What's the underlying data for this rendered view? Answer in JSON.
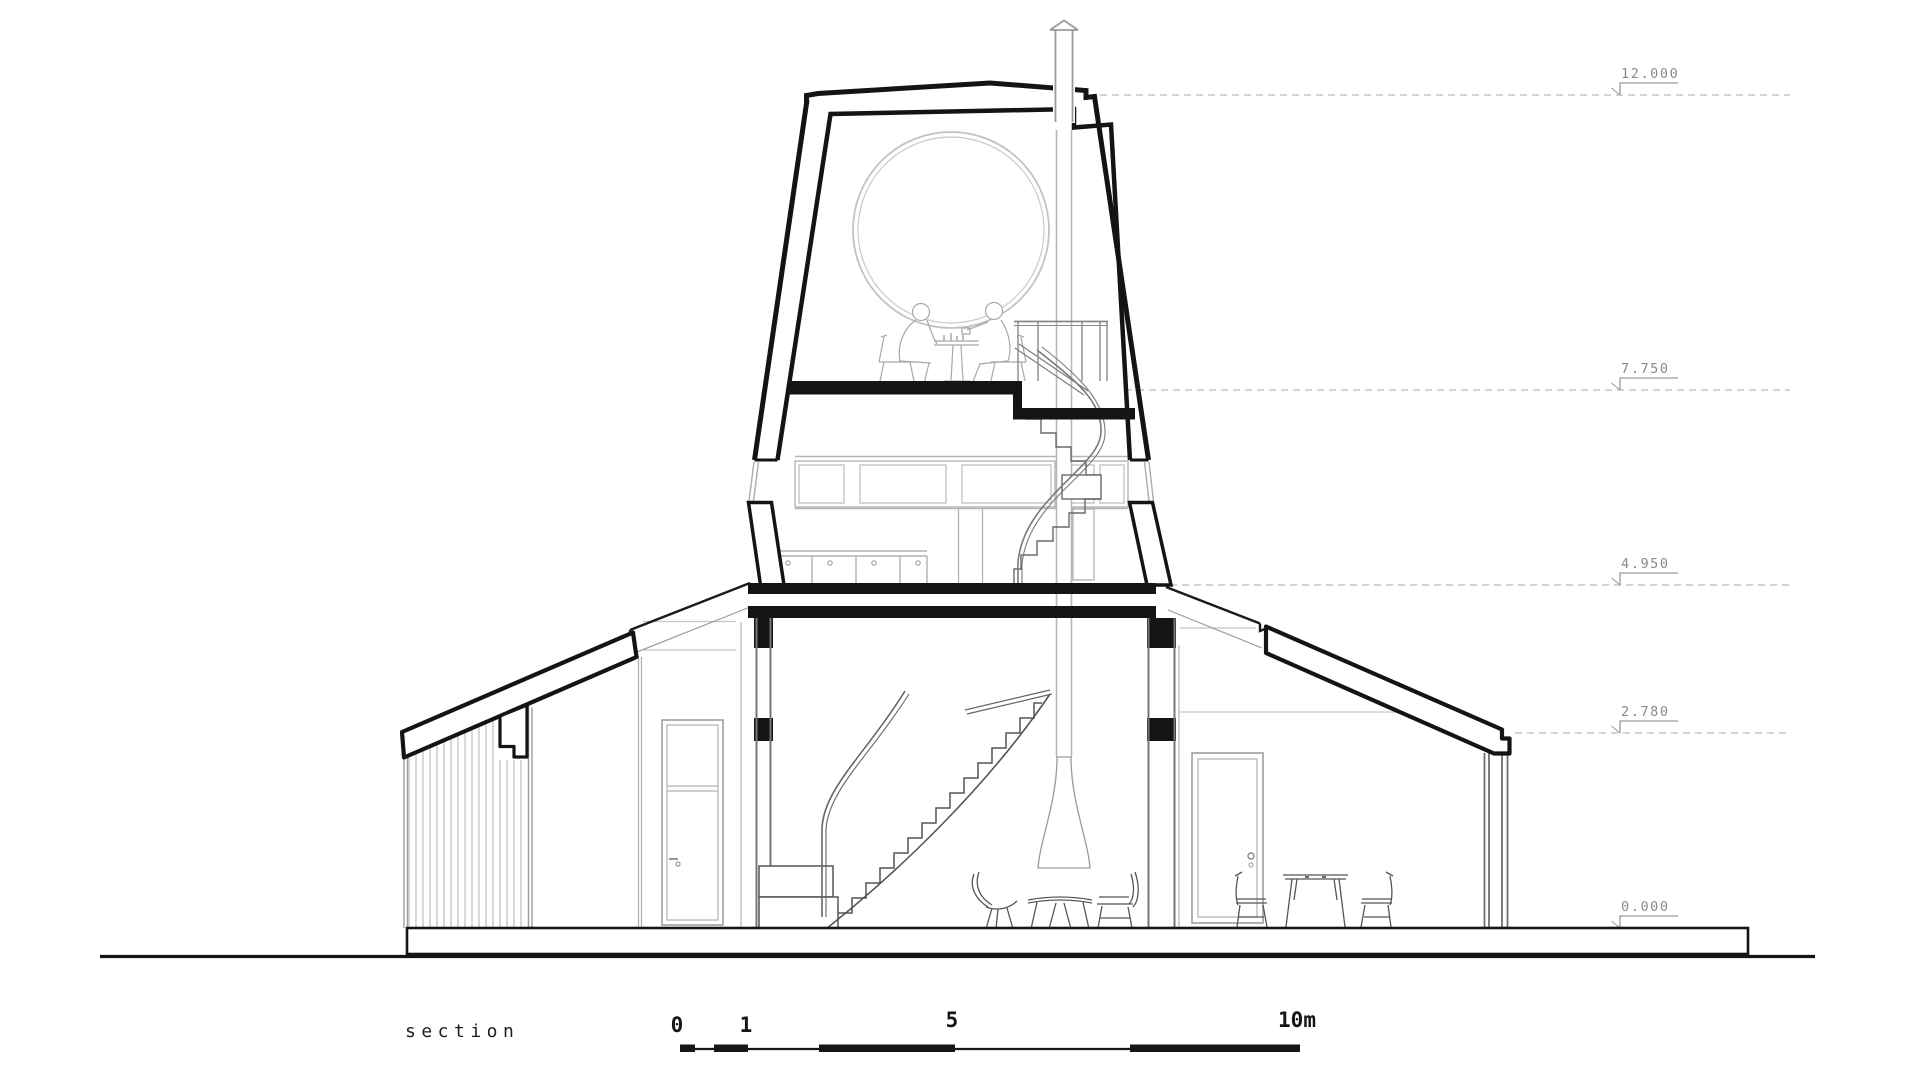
{
  "drawing": {
    "title_label": "section",
    "type": "architectural-section-drawing",
    "building": "tower house with side wings, spiral stair, round window, two figures at table",
    "elevation_markers": [
      {
        "label": "12.000"
      },
      {
        "label": "7.750"
      },
      {
        "label": "4.950"
      },
      {
        "label": "2.780"
      },
      {
        "label": "0.000"
      }
    ],
    "scale_bar": {
      "tick_labels": [
        "0",
        "1",
        "5",
        "10m"
      ]
    },
    "colors": {
      "ink": "#141414",
      "medium_line": "#555555",
      "light_line": "#b5b5b5",
      "dashed_line": "#c6c6c6",
      "marker_text": "#8a8a8a",
      "background": "#ffffff"
    }
  }
}
